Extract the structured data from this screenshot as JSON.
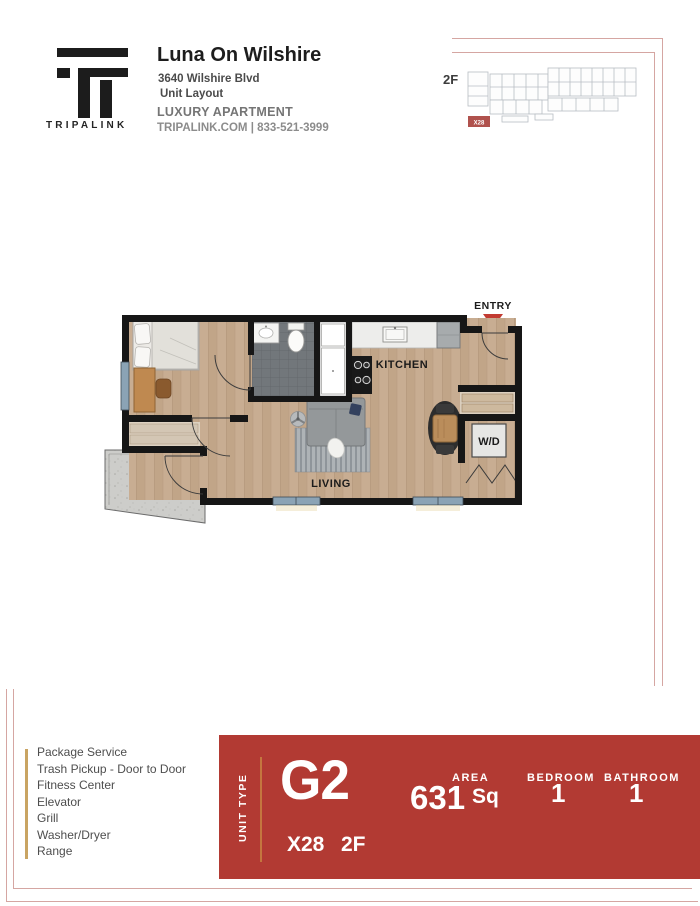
{
  "header": {
    "brand": "TRIPALINK",
    "property_name": "Luna On Wilshire",
    "address": "3640 Wilshire Blvd",
    "subtitle": "Unit Layout",
    "category": "LUXURY APARTMENT",
    "contact": "TRIPALINK.COM | 833-521-3999"
  },
  "site_map": {
    "floor_label": "2F",
    "highlighted_unit": "X28",
    "highlight_color": "#b0524d"
  },
  "floor_plan": {
    "labels": {
      "entry": "ENTRY",
      "kitchen": "KITCHEN",
      "living": "LIVING",
      "washer_dryer": "W/D"
    },
    "entry_arrow_color": "#c23b31"
  },
  "amenities": {
    "items": [
      "Package Service",
      "Trash Pickup - Door to Door",
      "Fitness Center",
      "Elevator",
      "Grill",
      "Washer/Dryer",
      "Range"
    ],
    "accent_line_color": "#c9a463"
  },
  "unit_banner": {
    "banner_color": "#b23a33",
    "accent_line_color": "#c4763f",
    "unit_type_label": "UNIT TYPE",
    "unit_type": "G2",
    "unit_number": "X28",
    "floor": "2F",
    "area_value": "631",
    "area_label": "AREA",
    "area_unit": "Sq",
    "bedroom_label": "BEDROOM",
    "bedroom_count": "1",
    "bathroom_label": "BATHROOM",
    "bathroom_count": "1"
  },
  "decor": {
    "frame_line_color": "#d5a6a2"
  }
}
